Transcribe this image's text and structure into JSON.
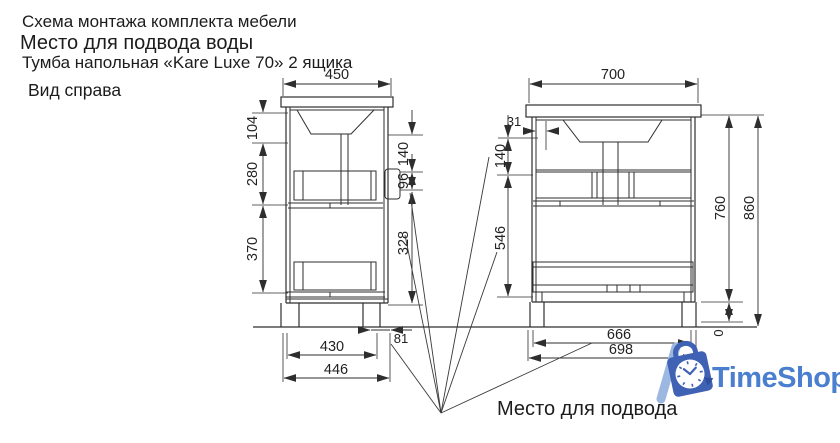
{
  "header": {
    "line1": "Схема монтажа комплекта мебели",
    "line2": "Место для подвода воды",
    "line3": "Тумба напольная «Kare Luxe 70» 2 ящика"
  },
  "view_label": "Вид справа",
  "water_note": "Место для подвода",
  "logo": {
    "text": "TimeShop"
  },
  "side_view": {
    "top_width": "450",
    "left_chain": {
      "d1": "104",
      "d2": "280",
      "d3": "370"
    },
    "right_chain": {
      "d1": "140",
      "d2": "96",
      "d3": "328"
    },
    "bottom_offset": "81",
    "bottom_inner": "430",
    "bottom_outer": "446"
  },
  "front_view": {
    "top_width": "700",
    "inlet_offset": "31",
    "left_chain": {
      "d1": "140",
      "d2": "546"
    },
    "height_body": "760",
    "height_total": "860",
    "bottom_inner": "666",
    "bottom_outer": "698",
    "floor_level": "0"
  },
  "colors": {
    "line": "#2e2e2e",
    "logo_blue": "#4a7fd0"
  }
}
